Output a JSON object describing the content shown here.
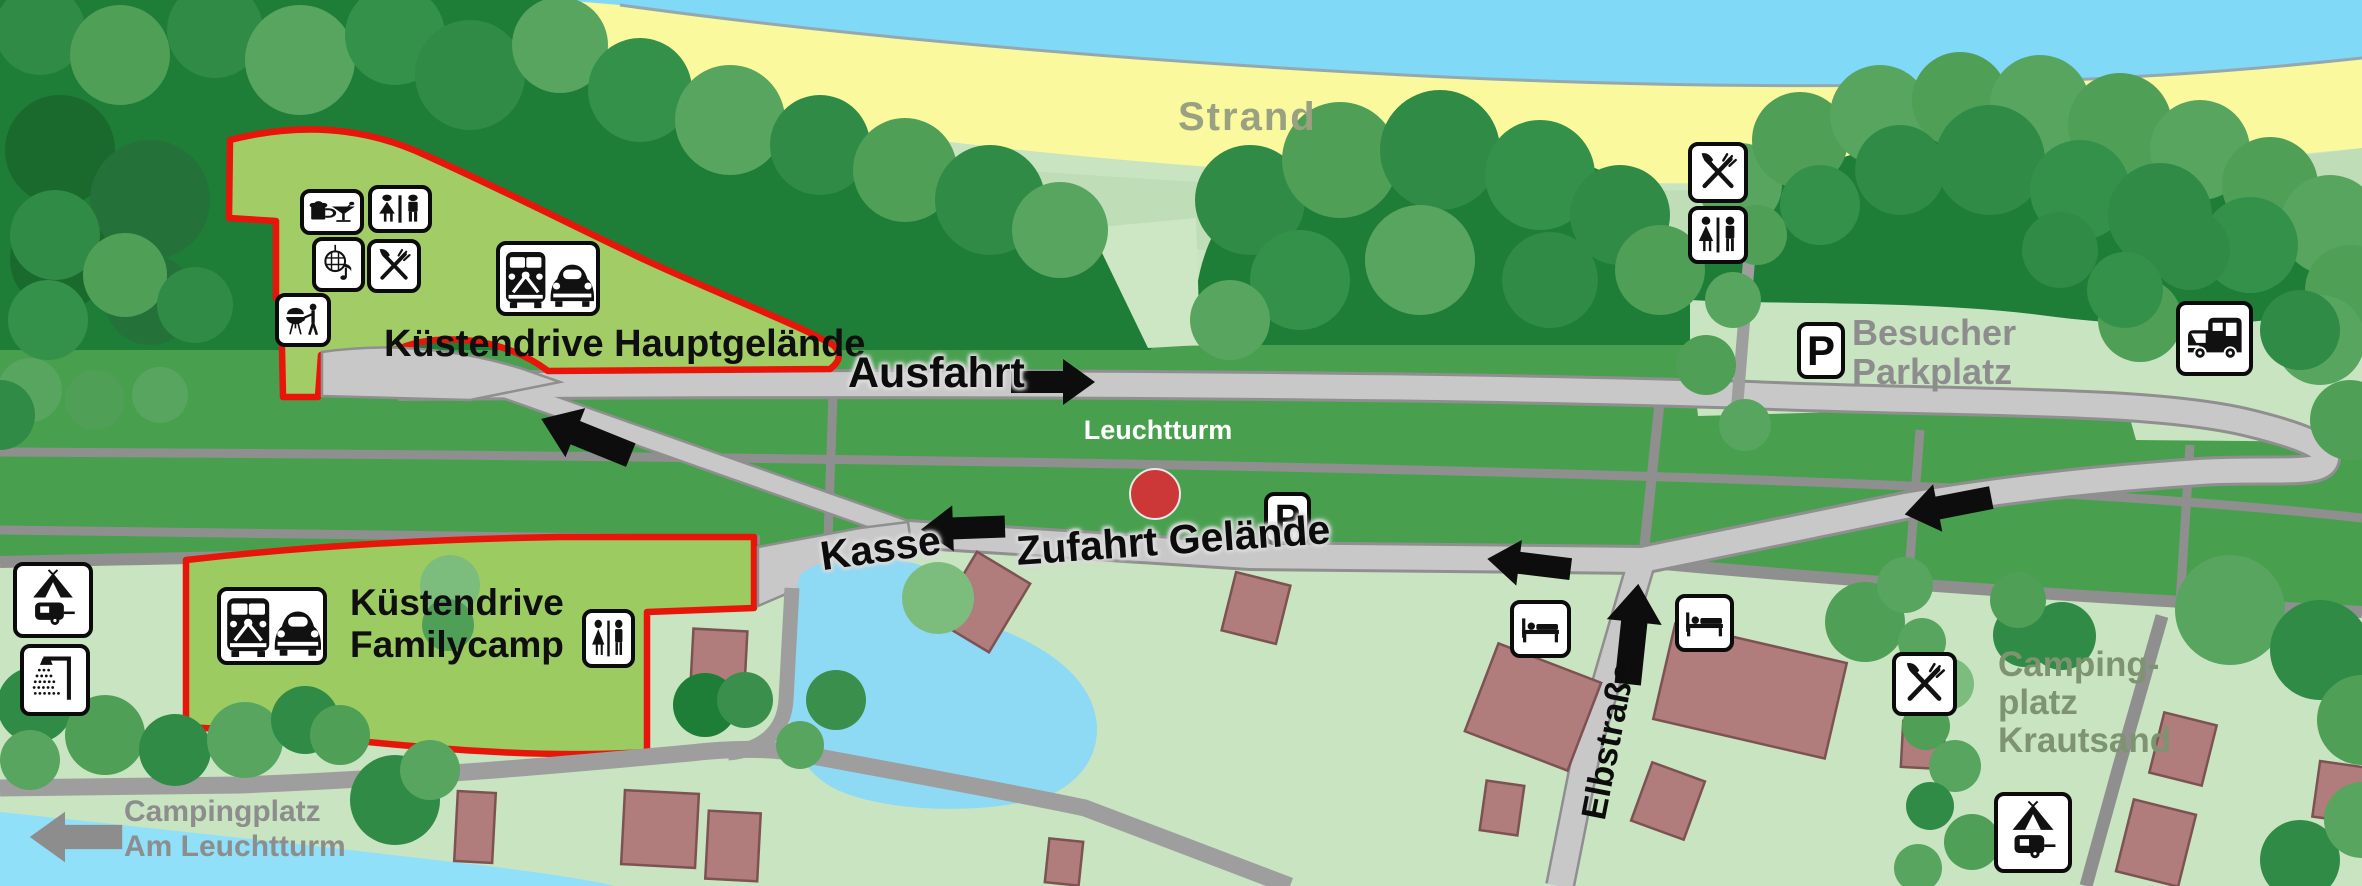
{
  "map_labels": {
    "strand": "Strand",
    "hauptgelaende": "Küstendrive Hauptgelände",
    "ausfahrt": "Ausfahrt",
    "leuchtturm": "Leuchtturm",
    "kasse": "Kasse",
    "zufahrt_gelaende": "Zufahrt Gelände",
    "besucher_parkplatz": {
      "line1": "Besucher",
      "line2": "Parkplatz"
    },
    "familycamp": {
      "line1": "Küstendrive",
      "line2": "Familycamp"
    },
    "krautsand": {
      "line1": "Camping-",
      "line2": "platz",
      "line3": "Krautsand"
    },
    "am_leuchtturm": {
      "line1": "Campingplatz",
      "line2": "Am Leuchtturm"
    },
    "elbstrasse": "Elbstraße",
    "parking_letter": "P"
  },
  "map_icons": [
    "bar-icon",
    "wc-icon",
    "disco-icon",
    "restaurant-icon",
    "bbq-icon",
    "vw-bus-and-beetle-icon",
    "tent-caravan-icon",
    "shower-icon",
    "bed-icon",
    "parking-icon",
    "motorhome-icon",
    "lighthouse-marker-dot",
    "direction-arrow",
    "campingplatz-am-leuchtturm-arrow"
  ],
  "colors": {
    "water": "#7FD9F7",
    "beach": "#FAF99E",
    "dune_grass": "#BFDDB7",
    "forest_dark": "#1E7D37",
    "field_green": "#48A04F",
    "light_green": "#C9E4C1",
    "camp_area_green": "#9FCB63",
    "camp_outline_red": "#E8150B",
    "marker_red": "#CB3837",
    "road_light": "#C8C8C8",
    "road_dark": "#8F8F8F",
    "building_brown": "#B07C7C",
    "label_gray": "#8D8D8D",
    "krautsand_label_green": "#7E9370"
  }
}
